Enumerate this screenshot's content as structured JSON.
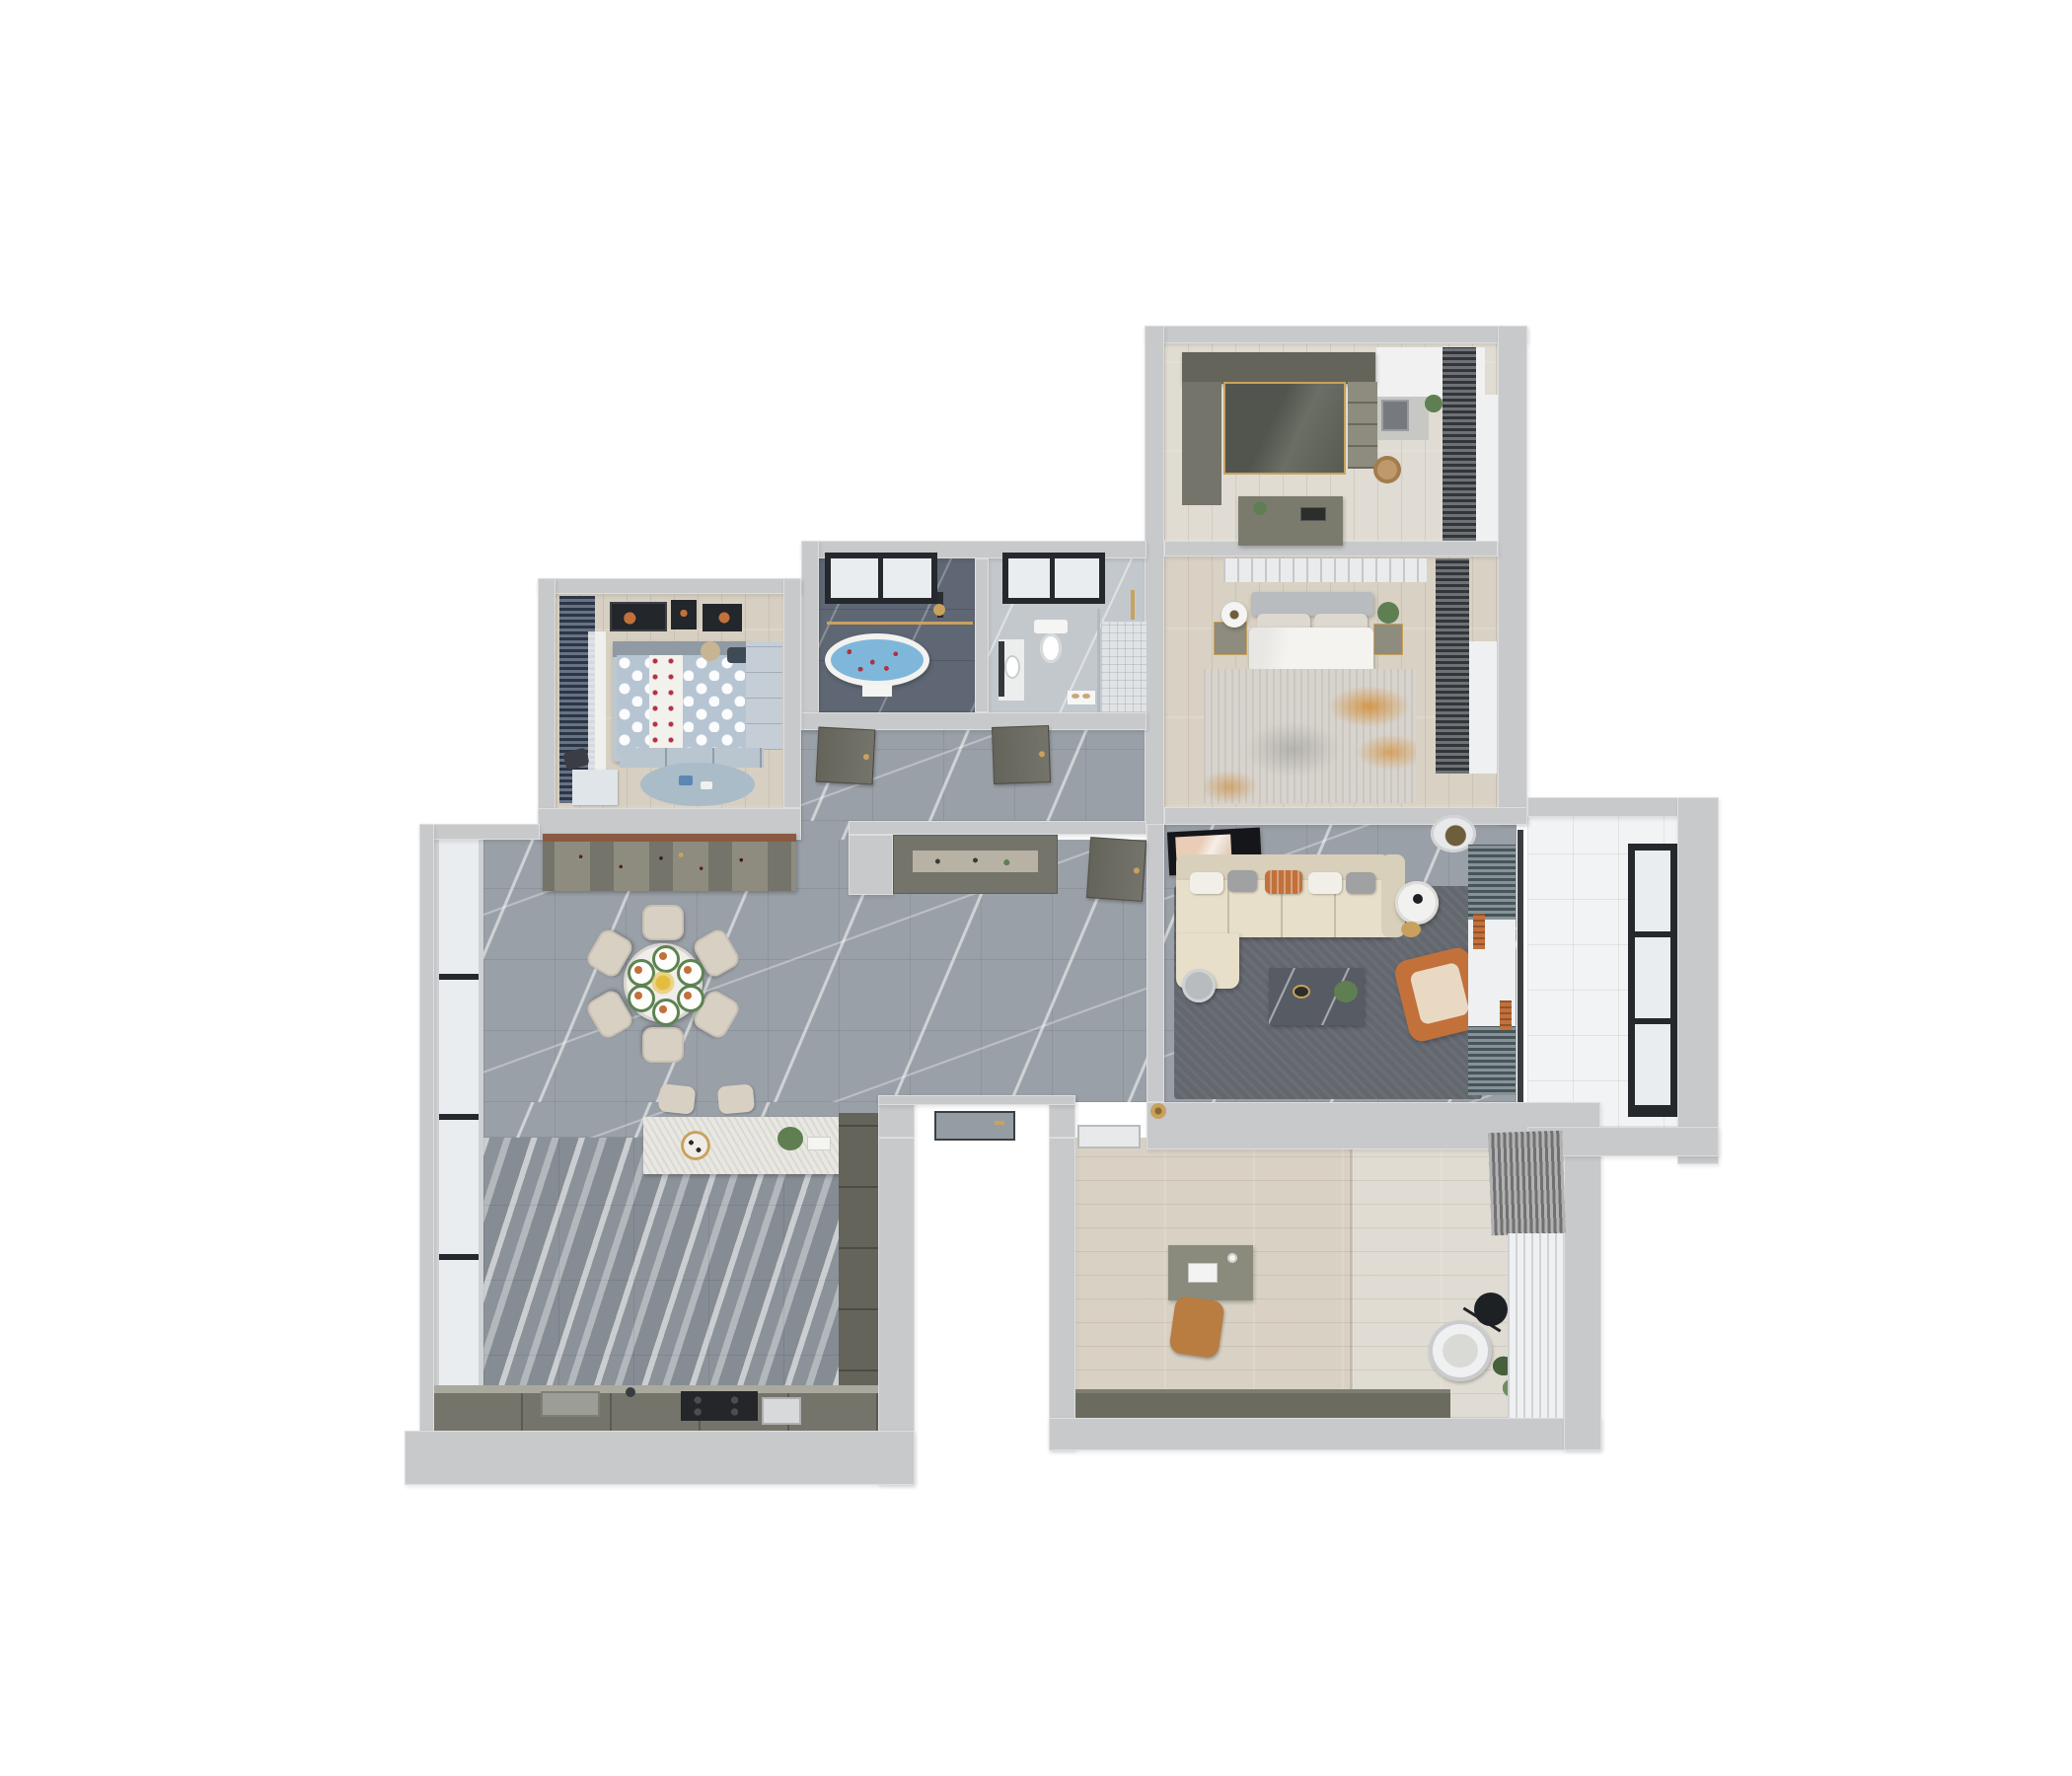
{
  "scene": {
    "title": "3D apartment floor plan render",
    "view": "top-down dollhouse",
    "background": "#ffffff"
  },
  "palette": {
    "bg": "#ffffff",
    "wall": "#c7c9cb",
    "marble": "#9aa0a7",
    "kitchenTile": "#969ca3",
    "wood": "#d9d2c4",
    "woodLight": "#e0dcd3",
    "woodKids": "#d7d0c2",
    "bathDark": "#5e6773",
    "bathLight": "#c3c8cd",
    "balconyTile": "#f2f3f4",
    "glass": "#e9edf0",
    "frameDark": "#25282c",
    "frameSilver": "#cfd2d4",
    "sheer": "#eef0f1",
    "charcoalCurtain": "#45494f",
    "navyCurtain": "#3c4a61",
    "tealCurtain": "#63757b",
    "grayCurtain": "#9c9c9e",
    "orange": "#c2713a",
    "orangeSoft": "#e3c08c",
    "gold": "#c9a15e",
    "sofa": "#e8dfca",
    "sofaShade": "#d9d0bb",
    "cream": "#d8d1c3",
    "rugLiving": "#63676e",
    "rugMaster": "#d8d4cd",
    "rugAccent": "#d4892c",
    "olive": "#75746a",
    "oliveDark": "#64645a",
    "oliveLight": "#8d8c7e",
    "woodTrim": "#8a5a42",
    "whiteSoft": "#f4f3ef",
    "kidsDuvet": "#b7c4d2",
    "kidsFurn": "#bcc8d2",
    "kidsRug": "#a9bcc8",
    "water": "#7fb7da",
    "petal": "#a93443",
    "plant": "#5f7f52",
    "plantDark": "#46603c",
    "tableDark": "#575b63",
    "plateRim": "#5c8352",
    "black": "#1a1c1f",
    "lampCore": "#6d5e3c"
  },
  "rooms": [
    {
      "id": "walk-in-closet",
      "position": "top-right",
      "floor": "light-wood",
      "furniture": [
        "wardrobe-run",
        "glass-door-wardrobe",
        "open-shelf-unit",
        "vanity-with-mirror",
        "island-dresser",
        "rattan-basket",
        "charcoal-curtains",
        "window"
      ]
    },
    {
      "id": "master-bedroom",
      "position": "right",
      "floor": "light-wood",
      "furniture": [
        "panel-headboard-wall",
        "double-bed",
        "white-duvet",
        "accent-pillow",
        "nightstand-left",
        "drum-table-lamp",
        "nightstand-right",
        "plant",
        "orange-accent-rug",
        "charcoal-curtains",
        "window"
      ]
    },
    {
      "id": "bathroom-dark",
      "position": "top-center",
      "floor": "dark-marble",
      "furniture": [
        "black-frame-window",
        "oval-bathtub-with-petals",
        "glass-partition",
        "shower-set",
        "towel"
      ]
    },
    {
      "id": "bathroom-light",
      "position": "top-center",
      "floor": "light-marble",
      "furniture": [
        "black-frame-window",
        "wall-hung-toilet",
        "vanity-sink",
        "mirror",
        "shower-glass",
        "gold-fixtures",
        "mosaic-shower-floor",
        "bath-mat",
        "slippers"
      ]
    },
    {
      "id": "kids-bedroom",
      "position": "top-left",
      "floor": "light-wood",
      "furniture": [
        "navy-curtains",
        "sheer-curtain",
        "wall-art-frames",
        "polka-dot-bed",
        "teddy-bear",
        "wardrobe",
        "drawer-chest",
        "round-rug",
        "toys",
        "desk",
        "desk-chair"
      ]
    },
    {
      "id": "hallway",
      "position": "center",
      "floor": "gray-marble",
      "furniture": [
        "bathroom-door-left",
        "bathroom-door-right",
        "master-suite-door"
      ]
    },
    {
      "id": "dining-room",
      "position": "center-left",
      "floor": "gray-marble",
      "furniture": [
        "wine-display-cabinet",
        "round-dining-table",
        "dining-chairs",
        "place-settings",
        "flower-centerpiece",
        "window-wall"
      ]
    },
    {
      "id": "foyer",
      "position": "center",
      "floor": "gray-marble",
      "furniture": [
        "shoe-cabinet",
        "entry-glass-door",
        "gold-floor-lamp"
      ]
    },
    {
      "id": "living-room",
      "position": "right",
      "floor": "gray-marble",
      "furniture": [
        "wall-tv",
        "sectional-sofa",
        "throw-pillows",
        "chaise",
        "gray-side-table",
        "round-white-table",
        "gold-stool",
        "marble-coffee-table",
        "plant",
        "orange-armchair",
        "dark-area-rug",
        "ceiling-ring-light",
        "teal-curtains",
        "sheer-curtain",
        "balcony-track"
      ]
    },
    {
      "id": "balcony",
      "position": "far-right",
      "floor": "white-tile",
      "furniture": [
        "panorama-window"
      ]
    },
    {
      "id": "kitchen",
      "position": "bottom-left",
      "floor": "striped-marble-tile",
      "furniture": [
        "island-counter",
        "bar-stools",
        "serving-tray",
        "plant",
        "cutting-board",
        "tall-cabinet-column",
        "base-cabinet-run",
        "sink",
        "faucet",
        "cooktop",
        "built-in-oven",
        "window-wall"
      ]
    },
    {
      "id": "study",
      "position": "bottom-right",
      "floor": "wood-planks",
      "furniture": [
        "entry-door",
        "writing-desk",
        "laptop",
        "coffee-cup",
        "task-chair",
        "lounge-chair",
        "arc-floor-lamp",
        "potted-plant",
        "low-cabinet-run",
        "gray-curtains",
        "sheer-curtains"
      ]
    }
  ],
  "counts": {
    "bedrooms": 2,
    "bathrooms": 2,
    "dining_chairs": 6,
    "place_settings": 6,
    "bar_stools": 2,
    "sofa_pillows": 5,
    "kids_art_frames": 3,
    "balcony_window_panes": 3
  }
}
